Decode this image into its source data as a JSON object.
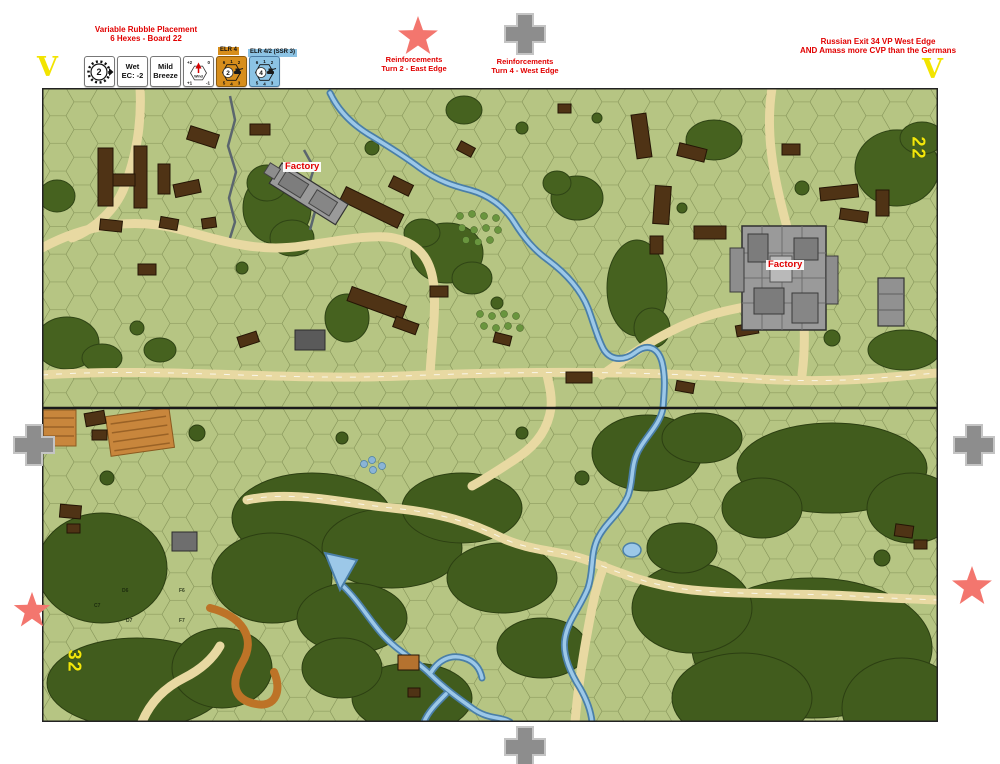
{
  "header": {
    "rubble_note": {
      "line1": "Variable Rubble Placement",
      "line2": "6 Hexes - Board 22"
    },
    "objective_note": {
      "line1": "Russian Exit 34 VP West Edge",
      "line2": "AND Amass more CVP than the Germans"
    },
    "reinforcement_east": {
      "line1": "Reinforcements",
      "line2": "Turn 2 - East Edge"
    },
    "reinforcement_west": {
      "line1": "Reinforcements",
      "line2": "Turn 4 - West Edge"
    },
    "victory_letter_left": "V",
    "victory_letter_right": "V",
    "counters": {
      "turn_marker": {
        "value": "2"
      },
      "weather": {
        "line1": "Wet",
        "line2": "EC: -2"
      },
      "breeze": {
        "line1": "Mild",
        "line2": "Breeze"
      },
      "wind": {
        "tl": "+2",
        "tr": "0",
        "bl": "+1",
        "br": "-1",
        "label": "Wind"
      },
      "elr_german": {
        "label": "ELR 4",
        "center": "2",
        "hex_numbers": [
          "6",
          "1",
          "2",
          "3",
          "4",
          "5"
        ]
      },
      "elr_russian": {
        "label": "ELR 4/2 (SSR 3)",
        "center": "4",
        "hex_numbers": [
          "6",
          "1",
          "2",
          "3",
          "4",
          "5"
        ]
      }
    }
  },
  "map": {
    "board_top_number": "22",
    "board_bottom_number": "32",
    "factory_label_left": "Factory",
    "factory_label_right": "Factory",
    "hex_labels": [
      "D6",
      "C7",
      "D7",
      "F6",
      "F7"
    ]
  },
  "colors": {
    "annotation_red": "#e10000",
    "russian_star": "#f3766e",
    "german_cross": "#8d8d8d",
    "board_number_yellow": "#f2e70a",
    "map_green": "#b6c583",
    "forest_green": "#42591e",
    "road_tan": "#e8d9a2",
    "stream_blue": "#8fc4e4",
    "building_brown": "#4f3315",
    "factory_gray": "#9a9a9a"
  }
}
